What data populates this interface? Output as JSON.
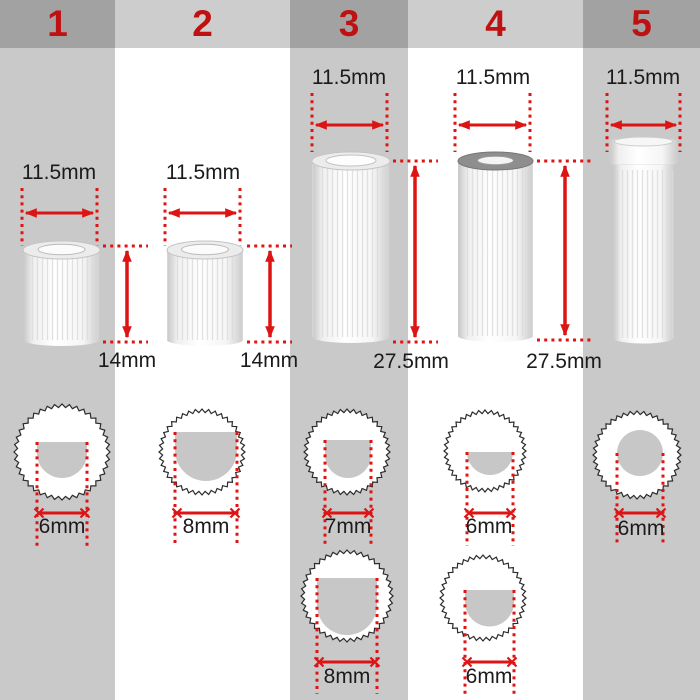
{
  "columns": [
    {
      "number": "1",
      "top_diameter": "11.5mm",
      "height": "14mm",
      "bottom_views": [
        {
          "inner_diameter": "6mm"
        }
      ]
    },
    {
      "number": "2",
      "top_diameter": "11.5mm",
      "height": "14mm",
      "bottom_views": [
        {
          "inner_diameter": "8mm"
        }
      ]
    },
    {
      "number": "3",
      "top_diameter": "11.5mm",
      "height": "27.5mm",
      "bottom_views": [
        {
          "inner_diameter": "7mm"
        },
        {
          "inner_diameter": "8mm"
        }
      ]
    },
    {
      "number": "4",
      "top_diameter": "11.5mm",
      "height": "27.5mm",
      "bottom_views": [
        {
          "inner_diameter": "6mm"
        },
        {
          "inner_diameter": "6mm"
        }
      ]
    },
    {
      "number": "5",
      "top_diameter": "11.5mm",
      "bottom_views": [
        {
          "inner_diameter": "6mm"
        }
      ]
    }
  ],
  "colors": {
    "accent_red": "#dd1414",
    "number_red": "#bf1111",
    "header_dark": "#a2a2a2",
    "header_light": "#cdcdcd",
    "column_gray": "#c9c9c9",
    "column_white": "#ffffff",
    "text_dark": "#1b1b1b",
    "inner_hole_gray": "#c7c7c7"
  }
}
